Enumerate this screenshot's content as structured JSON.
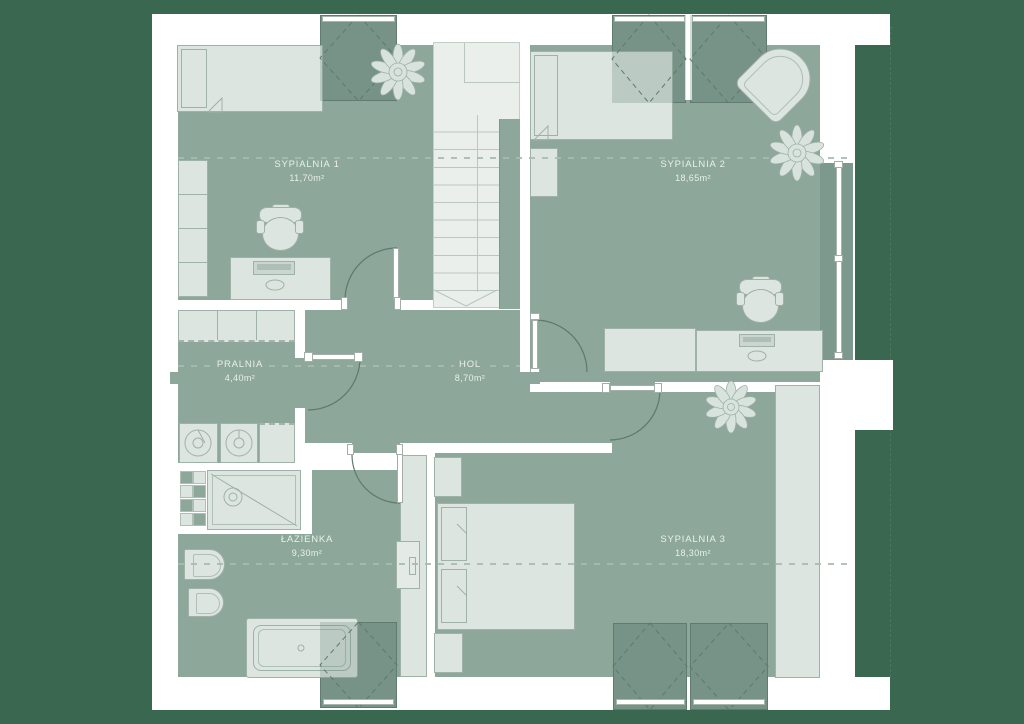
{
  "plan": {
    "title": "attic floor plan",
    "rooms": [
      {
        "name": "SYPIALNIA 1",
        "area": "11,70m²"
      },
      {
        "name": "SYPIALNIA 2",
        "area": "18,65m²"
      },
      {
        "name": "PRALNIA",
        "area": "4,40m²"
      },
      {
        "name": "HOL",
        "area": "8,70m²"
      },
      {
        "name": "ŁAZIENKA",
        "area": "9,30m²"
      },
      {
        "name": "SYPIALNIA 3",
        "area": "18,30m²"
      }
    ],
    "colors": {
      "background": "#3A6750",
      "floor": "#8DA79A",
      "skylight": "#7D988C",
      "furniture": "#DCE5E0",
      "furniture_border": "#9FB2A7",
      "wall": "#FFFFFF",
      "label_text": "#E9F0EA"
    }
  }
}
